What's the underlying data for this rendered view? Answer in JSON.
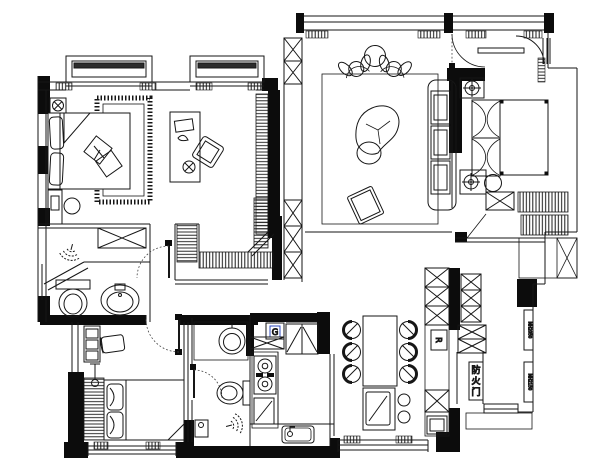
{
  "title": "residential-floor-plan",
  "canvas": {
    "width": 600,
    "height": 472
  },
  "colors": {
    "paper": "#ffffff",
    "ink": "#161616",
    "wall_fill": "#0c0c0c",
    "label_blue": "#2f4bbf",
    "code_gray": "#4a4a57"
  },
  "labels": {
    "fire_door": "防火门",
    "fire_door_chars": [
      "防",
      "火",
      "门"
    ],
    "gas_meter": "G",
    "riser": "R",
    "wall_code_upper": "MH2050",
    "wall_code_lower": "MH2150"
  }
}
